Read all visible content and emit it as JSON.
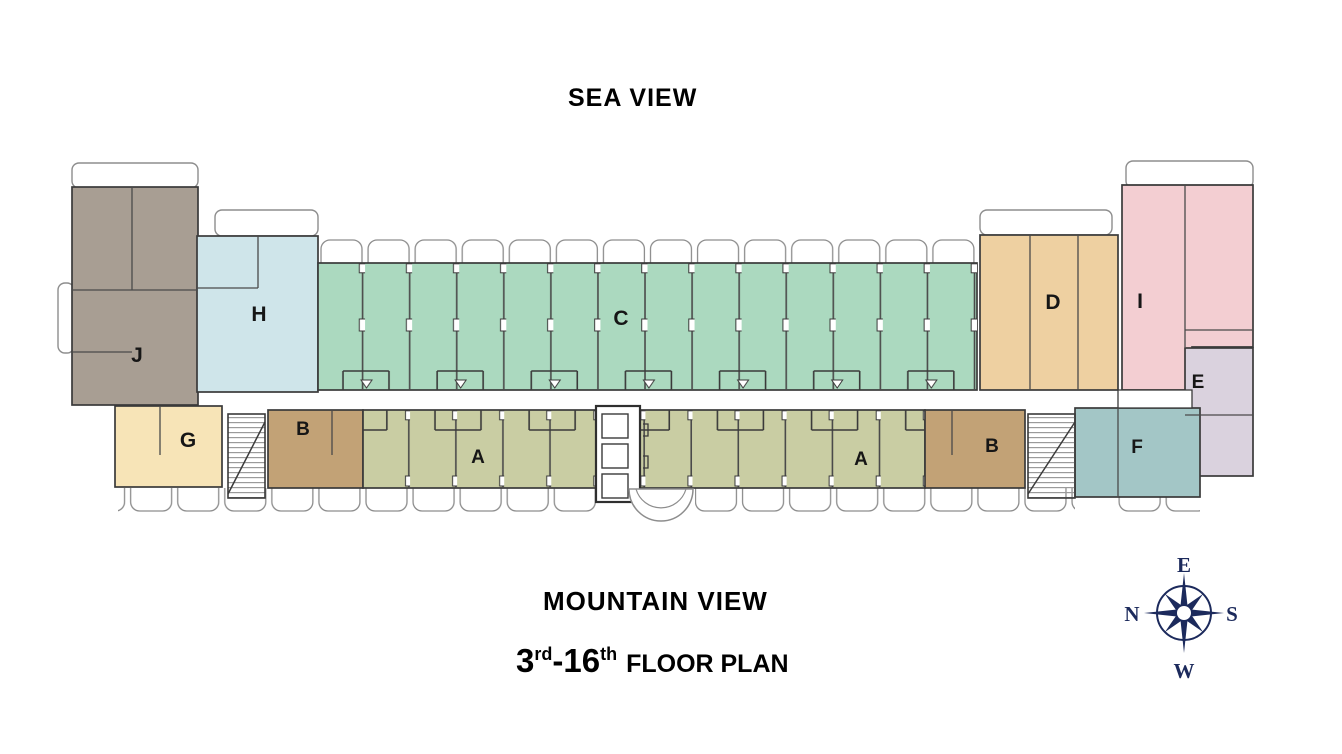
{
  "titles": {
    "top": "SEA VIEW",
    "bottom": "MOUNTAIN VIEW",
    "floor": {
      "n1": "3",
      "s1": "rd",
      "dash": "-",
      "n2": "16",
      "s2": "th",
      "rest": "FLOOR PLAN"
    }
  },
  "compass": {
    "top_letter": "E",
    "right_letter": "S",
    "bottom_letter": "W",
    "left_letter": "N",
    "color": "#1c2a5c"
  },
  "units": {
    "a_left": {
      "label": "A",
      "color": "#c9cda3"
    },
    "a_right": {
      "label": "A",
      "color": "#c9cda3"
    },
    "b_left": {
      "label": "B",
      "color": "#c2a276"
    },
    "b_right": {
      "label": "B",
      "color": "#c2a276"
    },
    "c": {
      "label": "C",
      "color": "#abd9bf"
    },
    "d": {
      "label": "D",
      "color": "#eed0a1"
    },
    "e": {
      "label": "E",
      "color": "#dad2de"
    },
    "f": {
      "label": "F",
      "color": "#a3c6c6"
    },
    "g": {
      "label": "G",
      "color": "#f7e4b7"
    },
    "h": {
      "label": "H",
      "color": "#cfe5ea"
    },
    "i": {
      "label": "I",
      "color": "#f3ced2"
    },
    "j": {
      "label": "J",
      "color": "#a89e93"
    }
  }
}
